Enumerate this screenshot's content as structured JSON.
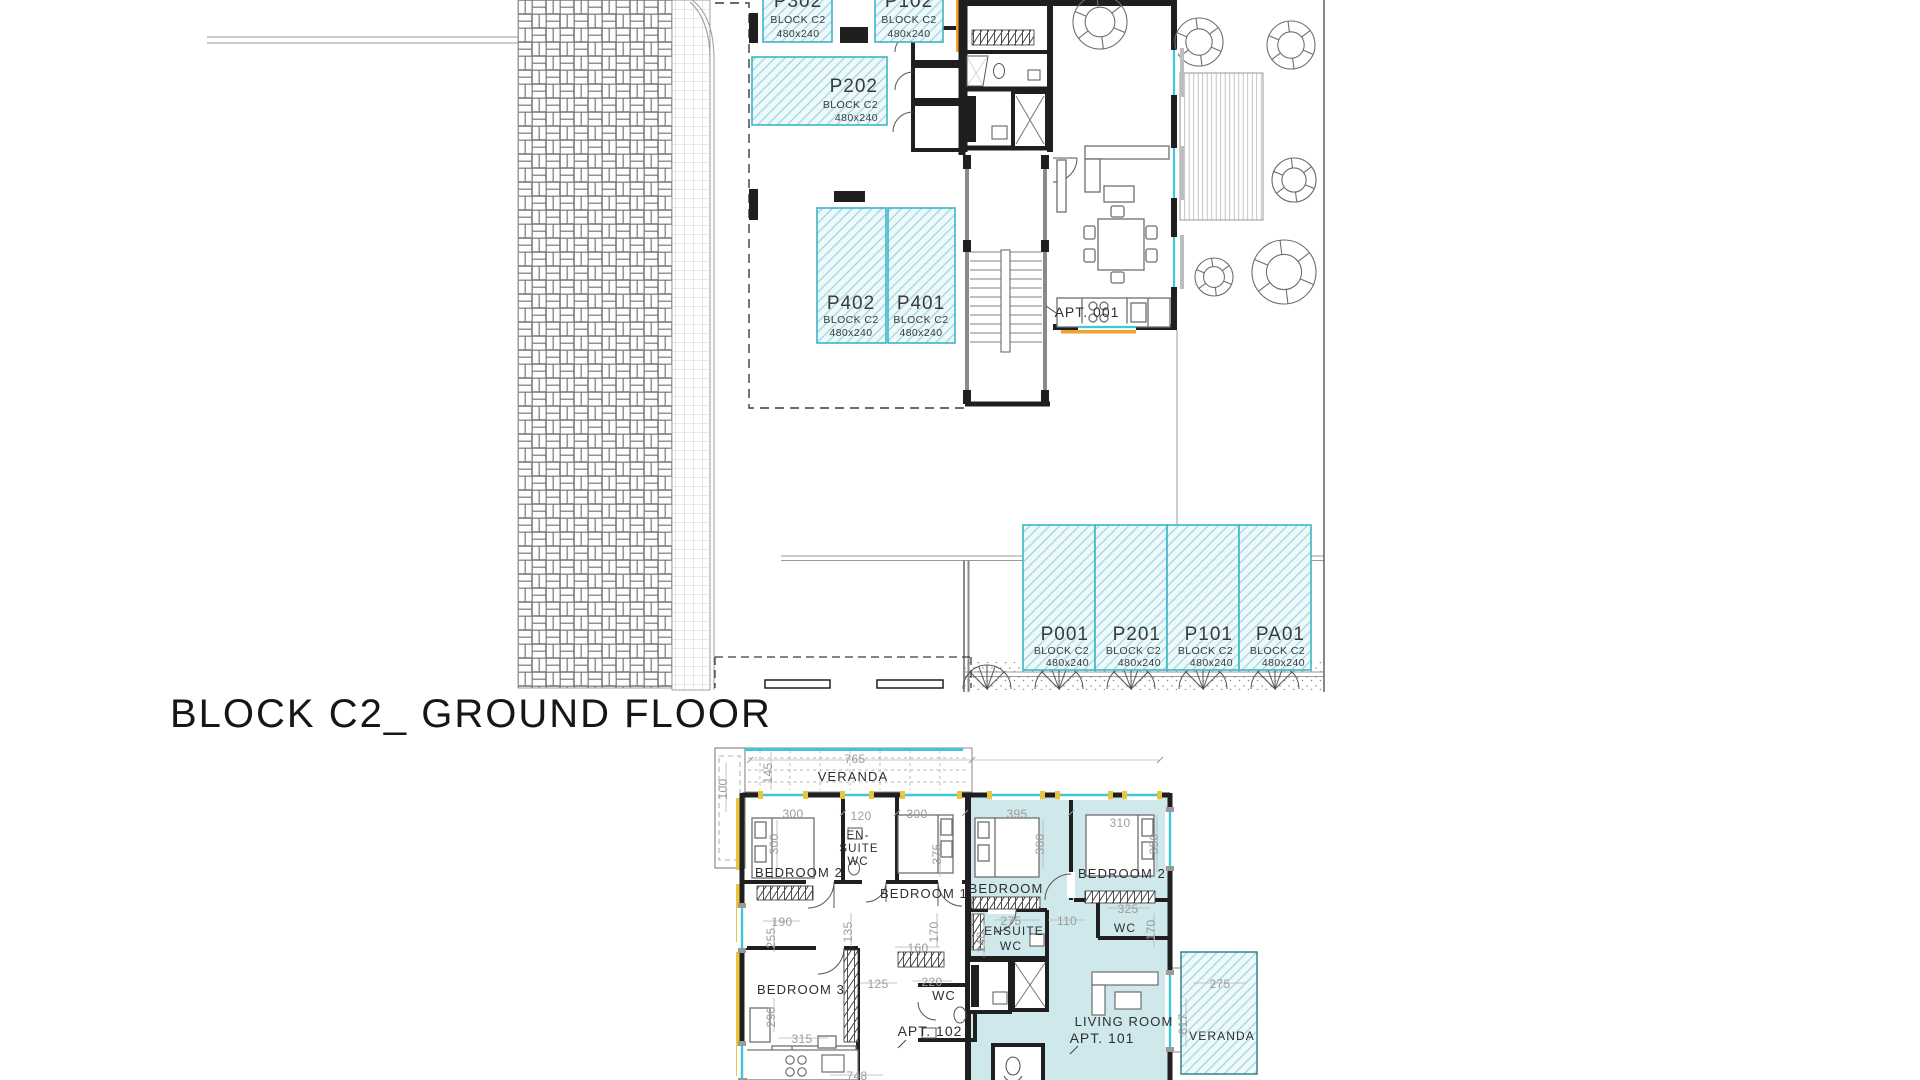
{
  "title": "BLOCK C2_ GROUND FLOOR",
  "colors": {
    "wall": "#1f1f1f",
    "parking_border": "#3cb6c6",
    "parking_hatch": "#9bd8e0",
    "parking_fill": "#eff9fb",
    "apartment_highlight": "#cfe8eb",
    "glazing": "#3ec7d6",
    "accent_yellow": "#e9c53d",
    "accent_orange": "#efa22f",
    "dim_text": "#9b9b9b",
    "label_text": "#2e2e2e"
  },
  "top_plan": {
    "apartment_label": {
      "text": "APT. 001",
      "x": 1087,
      "y": 317
    },
    "parking_stalls": [
      {
        "id": "P302",
        "block": "BLOCK C2",
        "size": "480x240",
        "x": 763,
        "y": -28,
        "w": 69,
        "h": 70,
        "lx": 798,
        "idy": 7,
        "by": 23,
        "sy": 37,
        "anchor": "middle"
      },
      {
        "id": "P102",
        "block": "BLOCK C2",
        "size": "480x240",
        "x": 875,
        "y": -28,
        "w": 68,
        "h": 70,
        "lx": 909,
        "idy": 7,
        "by": 23,
        "sy": 37,
        "anchor": "middle"
      },
      {
        "id": "P202",
        "block": "BLOCK C2",
        "size": "480x240",
        "x": 752,
        "y": 57,
        "w": 135,
        "h": 68,
        "lx": 878,
        "idy": 92,
        "by": 108,
        "sy": 121,
        "anchor": "end"
      },
      {
        "id": "P402",
        "block": "BLOCK C2",
        "size": "480x240",
        "x": 817,
        "y": 208,
        "w": 69,
        "h": 135,
        "lx": 851,
        "idy": 309,
        "by": 323,
        "sy": 336,
        "anchor": "middle"
      },
      {
        "id": "P401",
        "block": "BLOCK C2",
        "size": "480x240",
        "x": 888,
        "y": 208,
        "w": 67,
        "h": 135,
        "lx": 921,
        "idy": 309,
        "by": 323,
        "sy": 336,
        "anchor": "middle"
      },
      {
        "id": "P001",
        "block": "BLOCK C2",
        "size": "480x240",
        "x": 1023,
        "y": 525,
        "w": 72,
        "h": 145,
        "lx": 1089,
        "idy": 640,
        "by": 654,
        "sy": 666,
        "anchor": "end"
      },
      {
        "id": "P201",
        "block": "BLOCK C2",
        "size": "480x240",
        "x": 1095,
        "y": 525,
        "w": 72,
        "h": 145,
        "lx": 1161,
        "idy": 640,
        "by": 654,
        "sy": 666,
        "anchor": "end"
      },
      {
        "id": "P101",
        "block": "BLOCK C2",
        "size": "480x240",
        "x": 1167,
        "y": 525,
        "w": 72,
        "h": 145,
        "lx": 1233,
        "idy": 640,
        "by": 654,
        "sy": 666,
        "anchor": "end"
      },
      {
        "id": "PA01",
        "block": "BLOCK C2",
        "size": "480x240",
        "x": 1239,
        "y": 525,
        "w": 72,
        "h": 145,
        "lx": 1305,
        "idy": 640,
        "by": 654,
        "sy": 666,
        "anchor": "end"
      }
    ]
  },
  "bottom_plan": {
    "room_labels": [
      {
        "text": "VERANDA",
        "x": 853,
        "y": 781
      },
      {
        "text": "BEDROOM 2",
        "x": 799,
        "y": 877
      },
      {
        "text": "EN-",
        "x": 858,
        "y": 839,
        "size": 11.5
      },
      {
        "text": "SUITE",
        "x": 859,
        "y": 852,
        "size": 11.5
      },
      {
        "text": "WC",
        "x": 858,
        "y": 865,
        "size": 11.5
      },
      {
        "text": "BEDROOM 1",
        "x": 924,
        "y": 898
      },
      {
        "text": "BEDROOM",
        "x": 1006,
        "y": 893
      },
      {
        "text": "BEDROOM 2",
        "x": 1122,
        "y": 878
      },
      {
        "text": "BEDROOM 3",
        "x": 801,
        "y": 994
      },
      {
        "text": "WC",
        "x": 944,
        "y": 1000
      },
      {
        "text": "ENSUITE",
        "x": 1014,
        "y": 935,
        "size": 12
      },
      {
        "text": "WC",
        "x": 1011,
        "y": 950,
        "size": 12
      },
      {
        "text": "WC",
        "x": 1125,
        "y": 932,
        "size": 12
      },
      {
        "text": "LIVING ROOM",
        "x": 1124,
        "y": 1026
      },
      {
        "text": "VERANDA",
        "x": 1222,
        "y": 1040,
        "size": 12
      }
    ],
    "apartment_labels": [
      {
        "text": "APT. 102",
        "x": 930,
        "y": 1036
      },
      {
        "text": "APT. 101",
        "x": 1102,
        "y": 1043
      }
    ],
    "dim_labels": [
      {
        "text": "765",
        "x": 855,
        "y": 763
      },
      {
        "text": "145",
        "x": 772,
        "y": 773,
        "rot": true
      },
      {
        "text": "100",
        "x": 727,
        "y": 789,
        "rot": true
      },
      {
        "text": "300",
        "x": 793,
        "y": 818
      },
      {
        "text": "120",
        "x": 861,
        "y": 820
      },
      {
        "text": "300",
        "x": 917,
        "y": 818
      },
      {
        "text": "395",
        "x": 1017,
        "y": 818
      },
      {
        "text": "310",
        "x": 1120,
        "y": 827
      },
      {
        "text": "300",
        "x": 778,
        "y": 844,
        "rot": true
      },
      {
        "text": "375",
        "x": 941,
        "y": 854,
        "rot": true
      },
      {
        "text": "300",
        "x": 1044,
        "y": 844,
        "rot": true
      },
      {
        "text": "350",
        "x": 1158,
        "y": 844,
        "rot": true
      },
      {
        "text": "190",
        "x": 782,
        "y": 926
      },
      {
        "text": "255",
        "x": 775,
        "y": 938,
        "rot": true
      },
      {
        "text": "135",
        "x": 852,
        "y": 932,
        "rot": true
      },
      {
        "text": "170",
        "x": 938,
        "y": 932,
        "rot": true
      },
      {
        "text": "160",
        "x": 918,
        "y": 952
      },
      {
        "text": "275",
        "x": 1011,
        "y": 925
      },
      {
        "text": "110",
        "x": 1067,
        "y": 925
      },
      {
        "text": "140",
        "x": 985,
        "y": 942,
        "rot": true
      },
      {
        "text": "325",
        "x": 1128,
        "y": 913
      },
      {
        "text": "170",
        "x": 1155,
        "y": 930,
        "rot": true
      },
      {
        "text": "125",
        "x": 878,
        "y": 988
      },
      {
        "text": "220",
        "x": 932,
        "y": 986
      },
      {
        "text": "290",
        "x": 775,
        "y": 1017,
        "rot": true
      },
      {
        "text": "315",
        "x": 802,
        "y": 1043
      },
      {
        "text": "748",
        "x": 857,
        "y": 1080
      },
      {
        "text": "275",
        "x": 1220,
        "y": 988
      },
      {
        "text": "617",
        "x": 1187,
        "y": 1024,
        "rot": true
      }
    ]
  }
}
